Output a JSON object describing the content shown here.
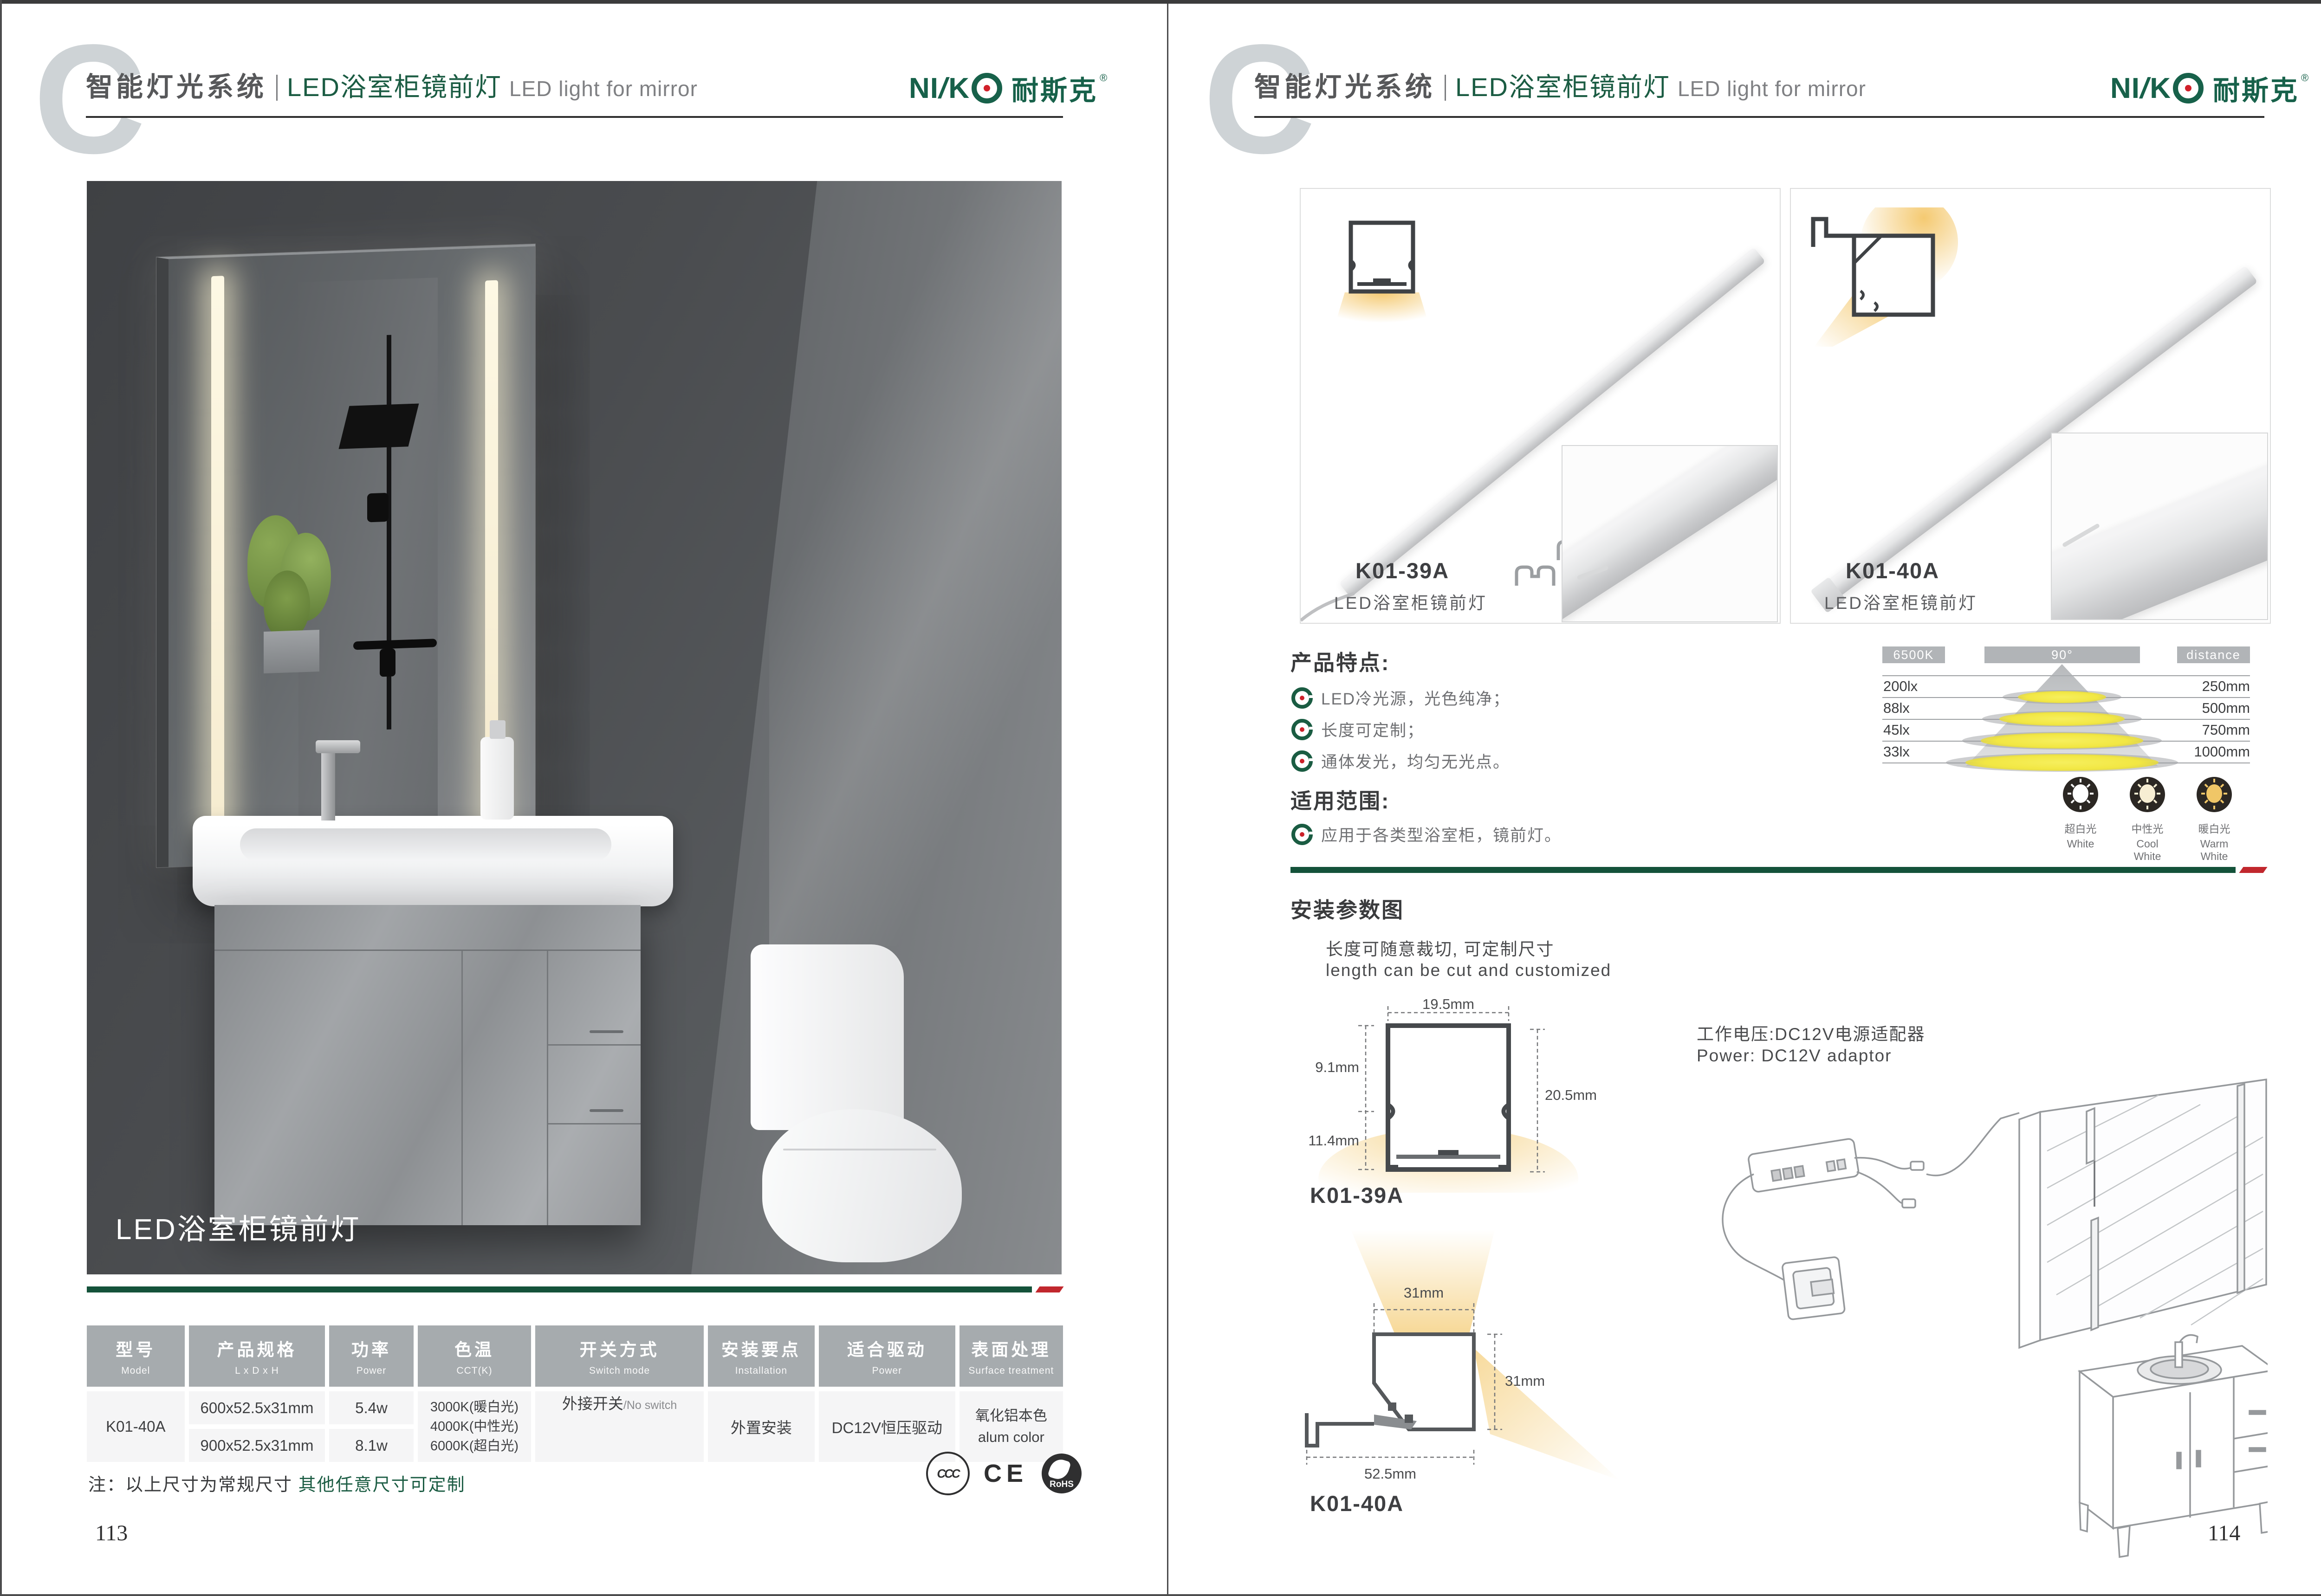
{
  "header": {
    "chapter_letter": "C",
    "category": "智能灯光系统",
    "title_cn": "LED浴室柜镜前灯",
    "title_en": "LED light for mirror"
  },
  "brand": {
    "latin_prefix": "NI",
    "latin_slash": "/",
    "latin_k": "K",
    "cn": "耐斯克",
    "reg": "®"
  },
  "left_page": {
    "photo_caption": "LED浴室柜镜前灯",
    "page_number": "113",
    "note_black": "注：以上尺寸为常规尺寸 ",
    "note_green": "其他任意尺寸可定制",
    "certs": {
      "ccc": "CCC",
      "ce": "CE",
      "rohs": "RoHS"
    },
    "table": {
      "headers": [
        {
          "zh": "型号",
          "en": "Model"
        },
        {
          "zh": "产品规格",
          "en": "L x D x H"
        },
        {
          "zh": "功率",
          "en": "Power"
        },
        {
          "zh": "色温",
          "en": "CCT(K)"
        },
        {
          "zh": "开关方式",
          "en": "Switch mode"
        },
        {
          "zh": "安装要点",
          "en": "Installation"
        },
        {
          "zh": "适合驱动",
          "en": "Power"
        },
        {
          "zh": "表面处理",
          "en": "Surface treatment"
        }
      ],
      "model": "K01-40A",
      "sizes": [
        "600x52.5x31mm",
        "900x52.5x31mm"
      ],
      "powers": [
        "5.4w",
        "8.1w"
      ],
      "cct": [
        "3000K(暖白光)",
        "4000K(中性光)",
        "6000K(超白光)"
      ],
      "switch_zh": "外接开关",
      "switch_en": "/No switch",
      "installation": "外置安装",
      "driver": "DC12V恒压驱动",
      "surface_line1": "氧化铝本色",
      "surface_line2": "alum color"
    }
  },
  "right_page": {
    "products": [
      {
        "model": "K01-39A",
        "name": "LED浴室柜镜前灯"
      },
      {
        "model": "K01-40A",
        "name": "LED浴室柜镜前灯"
      }
    ],
    "features": {
      "title": "产品特点:",
      "items": [
        "LED冷光源，光色纯净；",
        "长度可定制；",
        "通体发光，均匀无光点。"
      ]
    },
    "application": {
      "title": "适用范围:",
      "item": "应用于各类型浴室柜，镜前灯。"
    },
    "swatches": [
      {
        "zh": "超白光",
        "en": "White"
      },
      {
        "zh": "中性光",
        "en": "Cool White"
      },
      {
        "zh": "暖白光",
        "en": "Warm White"
      }
    ],
    "install": {
      "title": "安装参数图",
      "cut_cn": "长度可随意裁切, 可定制尺寸",
      "cut_en": "length can be cut and customized",
      "power_cn": "工作电压:DC12V电源适配器",
      "power_en": "Power: DC12V adaptor",
      "dim39": {
        "model": "K01-39A",
        "width_top": "19.5mm",
        "left_upper": "9.1mm",
        "left_lower": "11.4mm",
        "height_right": "20.5mm"
      },
      "dim40": {
        "model": "K01-40A",
        "width_top": "31mm",
        "height_right": "31mm",
        "width_bottom": "52.5mm"
      }
    },
    "page_number": "114"
  },
  "chart_data": {
    "type": "table",
    "title": "Illuminance vs distance (6500K, 90° beam)",
    "columns": [
      "6500K",
      "90°",
      "distance"
    ],
    "rows": [
      [
        "200lx",
        "250mm"
      ],
      [
        "88lx",
        "500mm"
      ],
      [
        "45lx",
        "750mm"
      ],
      [
        "33lx",
        "1000mm"
      ]
    ],
    "lux_values": [
      200,
      88,
      45,
      33
    ],
    "distance_mm": [
      250,
      500,
      750,
      1000
    ],
    "beam_angle_deg": 90,
    "cct_k": 6500,
    "legend_position": "none",
    "grid": true
  },
  "colors": {
    "accent_green": "#17614a",
    "line_green": "#14523a",
    "accent_red": "#c1272d",
    "header_gray": "#a6abae",
    "text_gray": "#58595b",
    "cone_yellow": "#f2e958",
    "warm_glow": "#f6d388"
  }
}
